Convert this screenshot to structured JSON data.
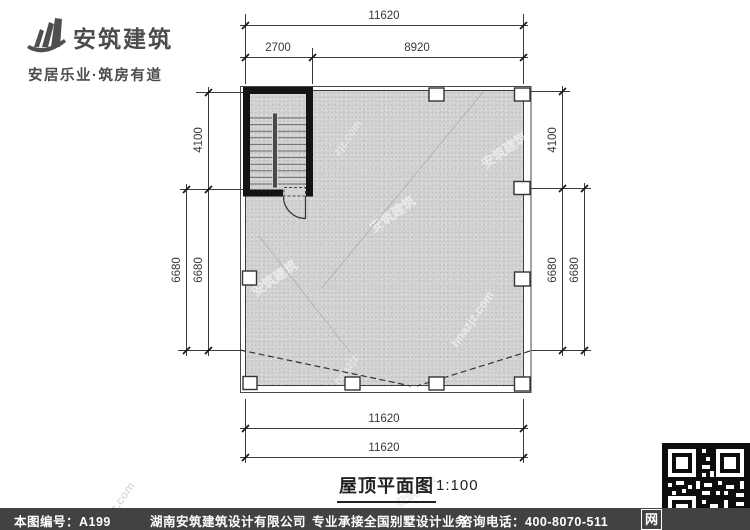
{
  "logo": {
    "name": "安筑建筑",
    "slogan": "安居乐业·筑房有道"
  },
  "drawing": {
    "title": "屋顶平面图",
    "scale": "1:100",
    "dims": {
      "top_total": "11620",
      "top_seg_left": "2700",
      "top_seg_right": "8920",
      "left_upper": "4100",
      "left_lower_inner": "6680",
      "left_lower_outer": "6680",
      "right_upper": "4100",
      "right_lower_inner": "6680",
      "right_lower_outer": "6680",
      "bottom_inner": "11620",
      "bottom_outer": "11620"
    },
    "watermark": {
      "brand": "安筑建筑",
      "site": "hnazjz.com",
      "site_short": "zjz.com",
      "site_frag": "hnazjz"
    }
  },
  "footer": {
    "serial": "本图编号：A199",
    "company": "湖南安筑建筑设计有限公司",
    "service": "专业承接全国别墅设计业务",
    "phone": "咨询电话：400-8070-511",
    "badge": "网"
  }
}
